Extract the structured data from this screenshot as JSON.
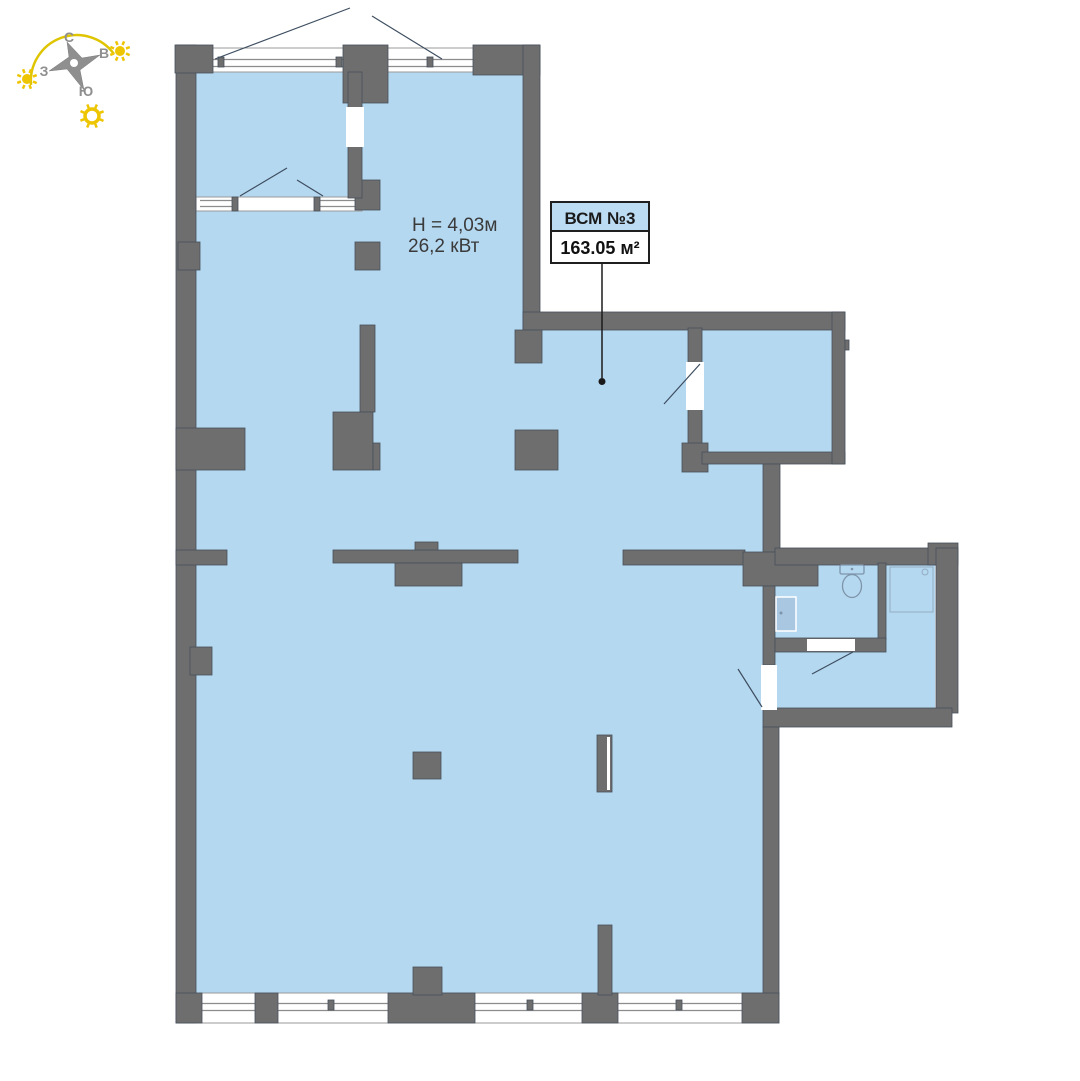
{
  "colors": {
    "floor": "#b5d8f1",
    "wall_fill": "#6e6e6e",
    "wall_stroke": "#46505a",
    "window_line": "#8c8c8c",
    "band_stroke": "#9a9a9a",
    "swing_line": "#3e4e60",
    "fixture_line": "#7d94a9",
    "fixture_light": "#93acc0",
    "basin_fill": "#a9c7e1",
    "leader_line": "#1a1a1a",
    "label_border": "#1f1f1f",
    "label_header_bg": "#bcdcf4",
    "compass_gray": "#8f8f8f",
    "sun_yellow": "#eec502",
    "arc_yellow": "#dfc400"
  },
  "compass": {
    "letters": {
      "n": "С",
      "e": "В",
      "s": "Ю",
      "w": "З"
    },
    "star_points": "67,42 82,58 100,55 80,70 84,90 67,69 49,71 69,57",
    "star_center": [
      74,
      63
    ],
    "arc_path": "M 31 85 A 46 46 0 0 1 114 54",
    "suns": [
      {
        "cx": 27,
        "cy": 79,
        "r": 5,
        "ring": false
      },
      {
        "cx": 120,
        "cy": 51,
        "r": 5,
        "ring": false
      },
      {
        "cx": 92,
        "cy": 116,
        "r": 7,
        "ring": true
      }
    ]
  },
  "annotations": {
    "height_label": "H = 4,03м",
    "power_label": "26,2 кВт"
  },
  "unit_label": {
    "name": "ВСМ №3",
    "area": "163.05 м²"
  },
  "floorplan": {
    "floors": [
      [
        196,
        70,
        327,
        927
      ],
      [
        523,
        330,
        240,
        667
      ],
      [
        702,
        325,
        130,
        127
      ],
      [
        775,
        565,
        160,
        145
      ],
      [
        773,
        586,
        45,
        54
      ]
    ],
    "bands": [
      [
        196,
        48,
        344,
        24
      ],
      [
        196,
        197,
        166,
        14
      ],
      [
        178,
        993,
        601,
        30
      ]
    ],
    "window_lines": [
      [
        213,
        59.5,
        343,
        59.5
      ],
      [
        213,
        66.5,
        343,
        66.5
      ],
      [
        388,
        59.5,
        473,
        59.5
      ],
      [
        388,
        66.5,
        473,
        66.5
      ],
      [
        200,
        200.5,
        232,
        200.5
      ],
      [
        200,
        206.5,
        232,
        206.5
      ],
      [
        320,
        200.5,
        356,
        200.5
      ],
      [
        320,
        206.5,
        356,
        206.5
      ],
      [
        202,
        1003.5,
        255,
        1003.5
      ],
      [
        202,
        1010.5,
        255,
        1010.5
      ],
      [
        278,
        1003.5,
        388,
        1003.5
      ],
      [
        278,
        1010.5,
        388,
        1010.5
      ],
      [
        475,
        1003.5,
        582,
        1003.5
      ],
      [
        475,
        1010.5,
        582,
        1010.5
      ],
      [
        618,
        1003.5,
        742,
        1003.5
      ],
      [
        618,
        1010.5,
        742,
        1010.5
      ]
    ],
    "walls": [
      [
        176,
        45,
        20,
        978
      ],
      [
        175,
        45,
        38,
        28
      ],
      [
        343,
        45,
        45,
        58
      ],
      [
        473,
        45,
        67,
        30
      ],
      [
        523,
        45,
        17,
        285
      ],
      [
        523,
        312,
        322,
        18
      ],
      [
        515,
        330,
        27,
        33
      ],
      [
        688,
        328,
        14,
        137
      ],
      [
        682,
        443,
        26,
        29
      ],
      [
        702,
        452,
        143,
        12
      ],
      [
        832,
        312,
        13,
        152
      ],
      [
        845,
        340,
        4,
        10
      ],
      [
        178,
        242,
        22,
        28
      ],
      [
        176,
        428,
        69,
        42
      ],
      [
        176,
        550,
        51,
        15
      ],
      [
        190,
        647,
        22,
        28
      ],
      [
        355,
        180,
        25,
        30
      ],
      [
        355,
        242,
        25,
        28
      ],
      [
        360,
        325,
        15,
        87
      ],
      [
        333,
        412,
        40,
        58
      ],
      [
        373,
        443,
        7,
        27
      ],
      [
        515,
        430,
        43,
        40
      ],
      [
        333,
        550,
        185,
        13
      ],
      [
        415,
        542,
        23,
        8
      ],
      [
        395,
        563,
        67,
        23
      ],
      [
        623,
        550,
        122,
        15
      ],
      [
        763,
        464,
        17,
        88
      ],
      [
        743,
        552,
        75,
        34
      ],
      [
        775,
        548,
        161,
        17
      ],
      [
        928,
        543,
        30,
        22
      ],
      [
        936,
        548,
        22,
        165
      ],
      [
        763,
        708,
        189,
        19
      ],
      [
        763,
        586,
        12,
        79
      ],
      [
        878,
        563,
        8,
        77
      ],
      [
        775,
        638,
        111,
        14
      ],
      [
        763,
        727,
        16,
        268
      ],
      [
        742,
        993,
        37,
        30
      ],
      [
        176,
        993,
        26,
        30
      ],
      [
        255,
        993,
        23,
        30
      ],
      [
        388,
        993,
        87,
        30
      ],
      [
        413,
        967,
        29,
        28
      ],
      [
        582,
        993,
        36,
        30
      ],
      [
        598,
        925,
        14,
        70
      ],
      [
        413,
        752,
        28,
        27
      ],
      [
        597,
        735,
        15,
        57
      ],
      [
        348,
        72,
        14,
        126
      ],
      [
        232,
        197,
        6,
        14
      ],
      [
        314,
        197,
        6,
        14
      ],
      [
        218,
        57,
        6,
        10
      ],
      [
        336,
        57,
        6,
        10
      ],
      [
        427,
        57,
        6,
        10
      ],
      [
        328,
        1000,
        6,
        10
      ],
      [
        527,
        1000,
        6,
        10
      ],
      [
        676,
        1000,
        6,
        10
      ]
    ],
    "door_gaps": [
      [
        686,
        362,
        18,
        48
      ],
      [
        346,
        107,
        18,
        40
      ],
      [
        761,
        665,
        16,
        45
      ],
      [
        807,
        639,
        48,
        12
      ],
      [
        607,
        737,
        3,
        53
      ]
    ],
    "swing_lines": [
      [
        215,
        59,
        350,
        8
      ],
      [
        372,
        16,
        442,
        59
      ],
      [
        240,
        196,
        287,
        168
      ],
      [
        297,
        180,
        323,
        196
      ],
      [
        664,
        404,
        700,
        364
      ],
      [
        738,
        669,
        762,
        707
      ],
      [
        812,
        674,
        853,
        652
      ]
    ],
    "leader": {
      "x": 602,
      "y1": 263,
      "y2": 378,
      "dot_y": 381.5,
      "dot_r": 3.5
    },
    "label_box": {
      "x": 551,
      "y": 202,
      "w": 98,
      "h": 61,
      "header_h": 29
    },
    "fixtures": {
      "toilet": {
        "tank": [
          840,
          565,
          24,
          9
        ],
        "bowl": {
          "cx": 852,
          "cy": 586,
          "rx": 9.5,
          "ry": 11.5
        },
        "button": {
          "cx": 852,
          "cy": 569,
          "r": 1.3
        }
      },
      "shower": {
        "tray": [
          890,
          567,
          43,
          45
        ],
        "drain": {
          "cx": 925,
          "cy": 572,
          "r": 3
        }
      },
      "basin": {
        "body": [
          776,
          597,
          20,
          34
        ],
        "dot": {
          "cx": 781,
          "cy": 613,
          "r": 1.5
        }
      }
    }
  }
}
